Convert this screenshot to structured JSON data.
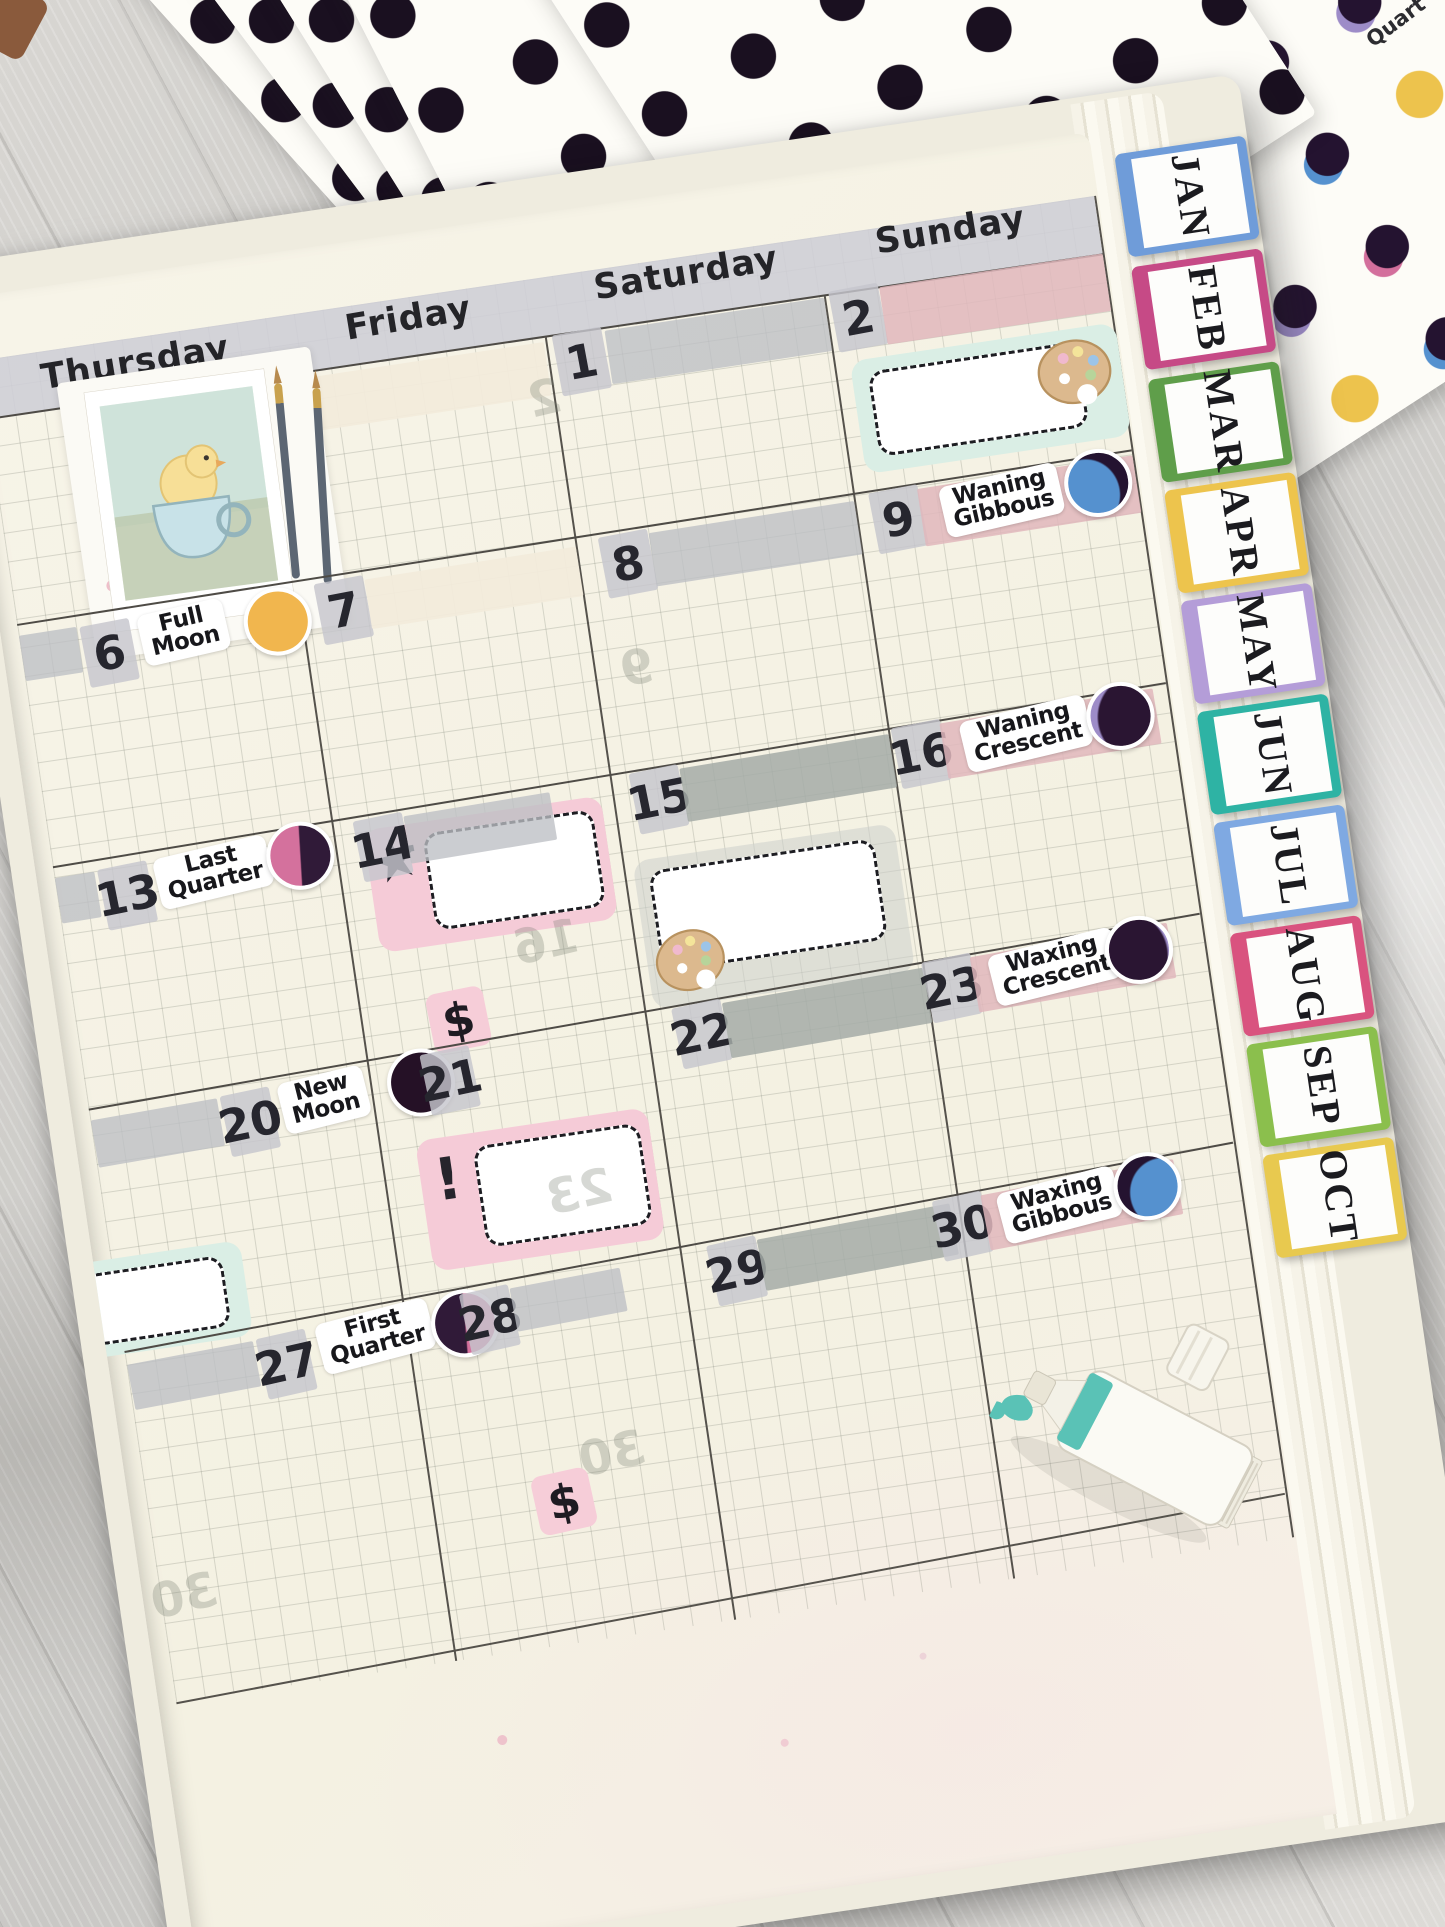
{
  "scene": {
    "corner_sheet_text": "Quart"
  },
  "colors": {
    "wood_gray": "#d2d0cc",
    "page_cream": "#f6f3e7",
    "header_gray": "rgba(206,206,214,0.88)",
    "washi_gray": "rgba(189,191,196,0.78)",
    "washi_gray_strong": "rgba(164,172,167,0.85)",
    "washi_pink": "rgba(225,183,188,0.85)",
    "washi_cream": "rgba(242,235,219,0.95)",
    "chip_gray": "rgba(198,198,205,0.82)",
    "box_mint": "#daeee5",
    "box_pink": "#f5cbd7",
    "box_gray": "rgba(204,208,204,0.55)",
    "sticker_black": "#1e1b22",
    "paint_teal": "#5ac2b6",
    "dot_black": "#1a1020",
    "dot_pink": "#d36f9c",
    "dot_purple": "#9d8cc8",
    "dot_blue": "#5591cf",
    "dot_yellow": "#edc34d"
  },
  "moon_styles": {
    "full_moon": "#f1b64e",
    "new_moon": "#251126",
    "last_quarter": "linear-gradient(96deg,#d4719d 49%,#301a38 51%)",
    "first_quarter": "linear-gradient(96deg,#301a38 49%,#d4719d 51%)",
    "waning_gibbous": "radial-gradient(95% 100% at 28% 66%,#5591cf 57%,#241330 60%)",
    "waning_crescent": "radial-gradient(110% 115% at 80% 58%,#2a1532 61%,#9d8cc8 64%)",
    "waxing_crescent": "radial-gradient(110% 115% at 28% 55%,#2a1532 61%,#9d8cc8 64%)",
    "waxing_gibbous": "radial-gradient(95% 100% at 74% 66%,#5591cf 57%,#241330 60%)"
  },
  "tabs": [
    {
      "label": "JAN",
      "color": "#6f9cd9"
    },
    {
      "label": "FEB",
      "color": "#c64a86"
    },
    {
      "label": "MAR",
      "color": "#5f9e4a"
    },
    {
      "label": "APR",
      "color": "#edc44d"
    },
    {
      "label": "MAY",
      "color": "#b49dd8"
    },
    {
      "label": "JUN",
      "color": "#2eb3a4"
    },
    {
      "label": "JUL",
      "color": "#7fa9e2"
    },
    {
      "label": "AUG",
      "color": "#d9537f"
    },
    {
      "label": "SEP",
      "color": "#8bbf4d"
    },
    {
      "label": "OCT",
      "color": "#e8c94f"
    }
  ],
  "calendar": {
    "day_headers": [
      "Thursday",
      "Friday",
      "Saturday",
      "Sunday"
    ],
    "entries": [
      {
        "date": "1",
        "day": "Saturday",
        "week": 1
      },
      {
        "date": "2",
        "day": "Sunday",
        "week": 1
      },
      {
        "date": "6",
        "day": "Thursday",
        "week": 2,
        "moon": "Full Moon",
        "moon_l1": "Full",
        "moon_l2": "Moon"
      },
      {
        "date": "7",
        "day": "Friday",
        "week": 2
      },
      {
        "date": "8",
        "day": "Saturday",
        "week": 2
      },
      {
        "date": "9",
        "day": "Sunday",
        "week": 2,
        "moon": "Waning Gibbous",
        "moon_l1": "Waning",
        "moon_l2": "Gibbous"
      },
      {
        "date": "13",
        "day": "Thursday",
        "week": 3,
        "moon": "Last Quarter",
        "moon_l1": "Last",
        "moon_l2": "Quarter"
      },
      {
        "date": "14",
        "day": "Friday",
        "week": 3
      },
      {
        "date": "15",
        "day": "Saturday",
        "week": 3
      },
      {
        "date": "16",
        "day": "Sunday",
        "week": 3,
        "moon": "Waning Crescent",
        "moon_l1": "Waning",
        "moon_l2": "Crescent"
      },
      {
        "date": "20",
        "day": "Thursday",
        "week": 4,
        "moon": "New Moon",
        "moon_l1": "New",
        "moon_l2": "Moon"
      },
      {
        "date": "21",
        "day": "Friday",
        "week": 4
      },
      {
        "date": "22",
        "day": "Saturday",
        "week": 4
      },
      {
        "date": "23",
        "day": "Sunday",
        "week": 4,
        "moon": "Waxing Crescent",
        "moon_l1": "Waxing",
        "moon_l2": "Crescent"
      },
      {
        "date": "27",
        "day": "Thursday",
        "week": 5,
        "moon": "First Quarter",
        "moon_l1": "First",
        "moon_l2": "Quarter"
      },
      {
        "date": "28",
        "day": "Friday",
        "week": 5
      },
      {
        "date": "29",
        "day": "Saturday",
        "week": 5
      },
      {
        "date": "30",
        "day": "Sunday",
        "week": 5,
        "moon": "Waxing Gibbous",
        "moon_l1": "Waxing",
        "moon_l2": "Gibbous"
      }
    ]
  },
  "stickers": {
    "dollar": "$",
    "exclamation": "!",
    "star": "★"
  },
  "ghost_numbers": [
    "2",
    "9",
    "16",
    "23",
    "30",
    "30"
  ]
}
